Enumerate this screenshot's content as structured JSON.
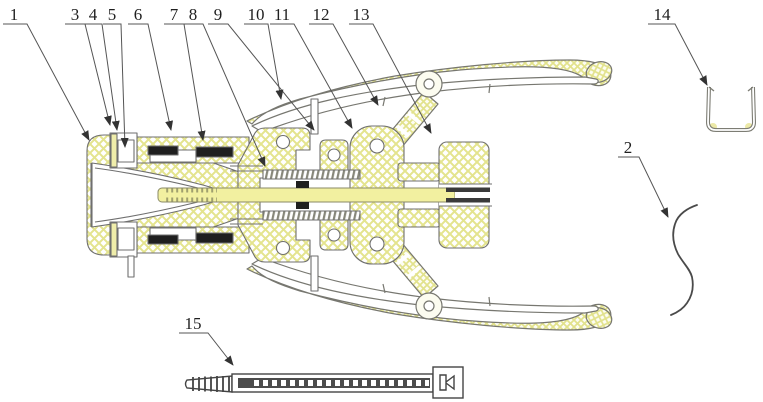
{
  "figure": {
    "type": "patent-style technical sectional drawing of a clamping/anastomosis instrument with detached parts (spring wire, U-clip, cable tie)",
    "colors": {
      "line": "#6f6f6f",
      "dark_line": "#3a3a3a",
      "hatch": "#e4e48e",
      "shaft_fill": "#f2f0a0",
      "seal": "#1f1f1f",
      "background": "#ffffff"
    },
    "callouts": [
      {
        "id": "1",
        "text": "1"
      },
      {
        "id": "3",
        "text": "3"
      },
      {
        "id": "4",
        "text": "4"
      },
      {
        "id": "5",
        "text": "5"
      },
      {
        "id": "6",
        "text": "6"
      },
      {
        "id": "7",
        "text": "7"
      },
      {
        "id": "8",
        "text": "8"
      },
      {
        "id": "9",
        "text": "9"
      },
      {
        "id": "10",
        "text": "10"
      },
      {
        "id": "11",
        "text": "11"
      },
      {
        "id": "12",
        "text": "12"
      },
      {
        "id": "13",
        "text": "13"
      },
      {
        "id": "14",
        "text": "14"
      },
      {
        "id": "2",
        "text": "2"
      },
      {
        "id": "15",
        "text": "15"
      }
    ]
  }
}
